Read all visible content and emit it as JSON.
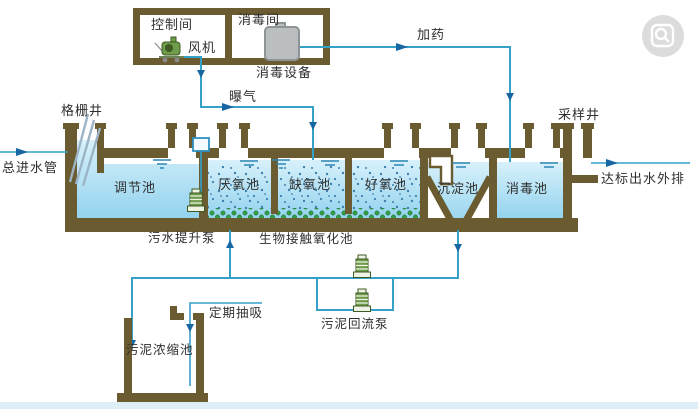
{
  "palette": {
    "wall": "#6a5b31",
    "pipe": "#35a0c8",
    "arrow": "#1867a3",
    "waterTop": "#d8f1fb",
    "waterBot": "#93d3ee",
    "media": "#2f9e44",
    "mediaDark": "#1c6b2c",
    "speckle": "#3d7fae",
    "pumpBody": "#6f9c4a",
    "pumpDark": "#3e5a23",
    "pumpLight": "#eef3e4",
    "pumpBox": "#2f8fc0",
    "equipGray": "#babec0",
    "equipStroke": "#8d9496",
    "ripple": "#2e86b5",
    "screenBar": "#9db4c6",
    "text": "#2f2f2f",
    "stripBottom": "#ddeef6",
    "badge": "#d4d4d4",
    "badgeGlyph": "#ffffff"
  },
  "building": {
    "control_room": "控制间",
    "fan": "风机",
    "disinfection_room": "消毒间",
    "disinfection_equipment": "消毒设备"
  },
  "flows": {
    "main_inlet": "总进水管",
    "aeration": "曝气",
    "dosing": "加药",
    "outlet": "达标出水外排",
    "periodic_suction": "定期抽吸"
  },
  "wells": {
    "grid_well": "格栅井",
    "sampling_well": "采样井"
  },
  "tanks": {
    "regulation": "调节池",
    "anaerobic": "厌氧池",
    "anoxic": "缺氧池",
    "aerobic": "好氧池",
    "bio_contact": "生物接触氧化池",
    "sedimentation": "沉淀池",
    "disinfection": "消毒池",
    "sludge_thickening": "污泥浓缩池"
  },
  "pumps": {
    "sewage_lift": "污水提升泵",
    "sludge_return": "污泥回流泵"
  },
  "icons": {
    "viewer_badge": "magnifier-preview"
  }
}
